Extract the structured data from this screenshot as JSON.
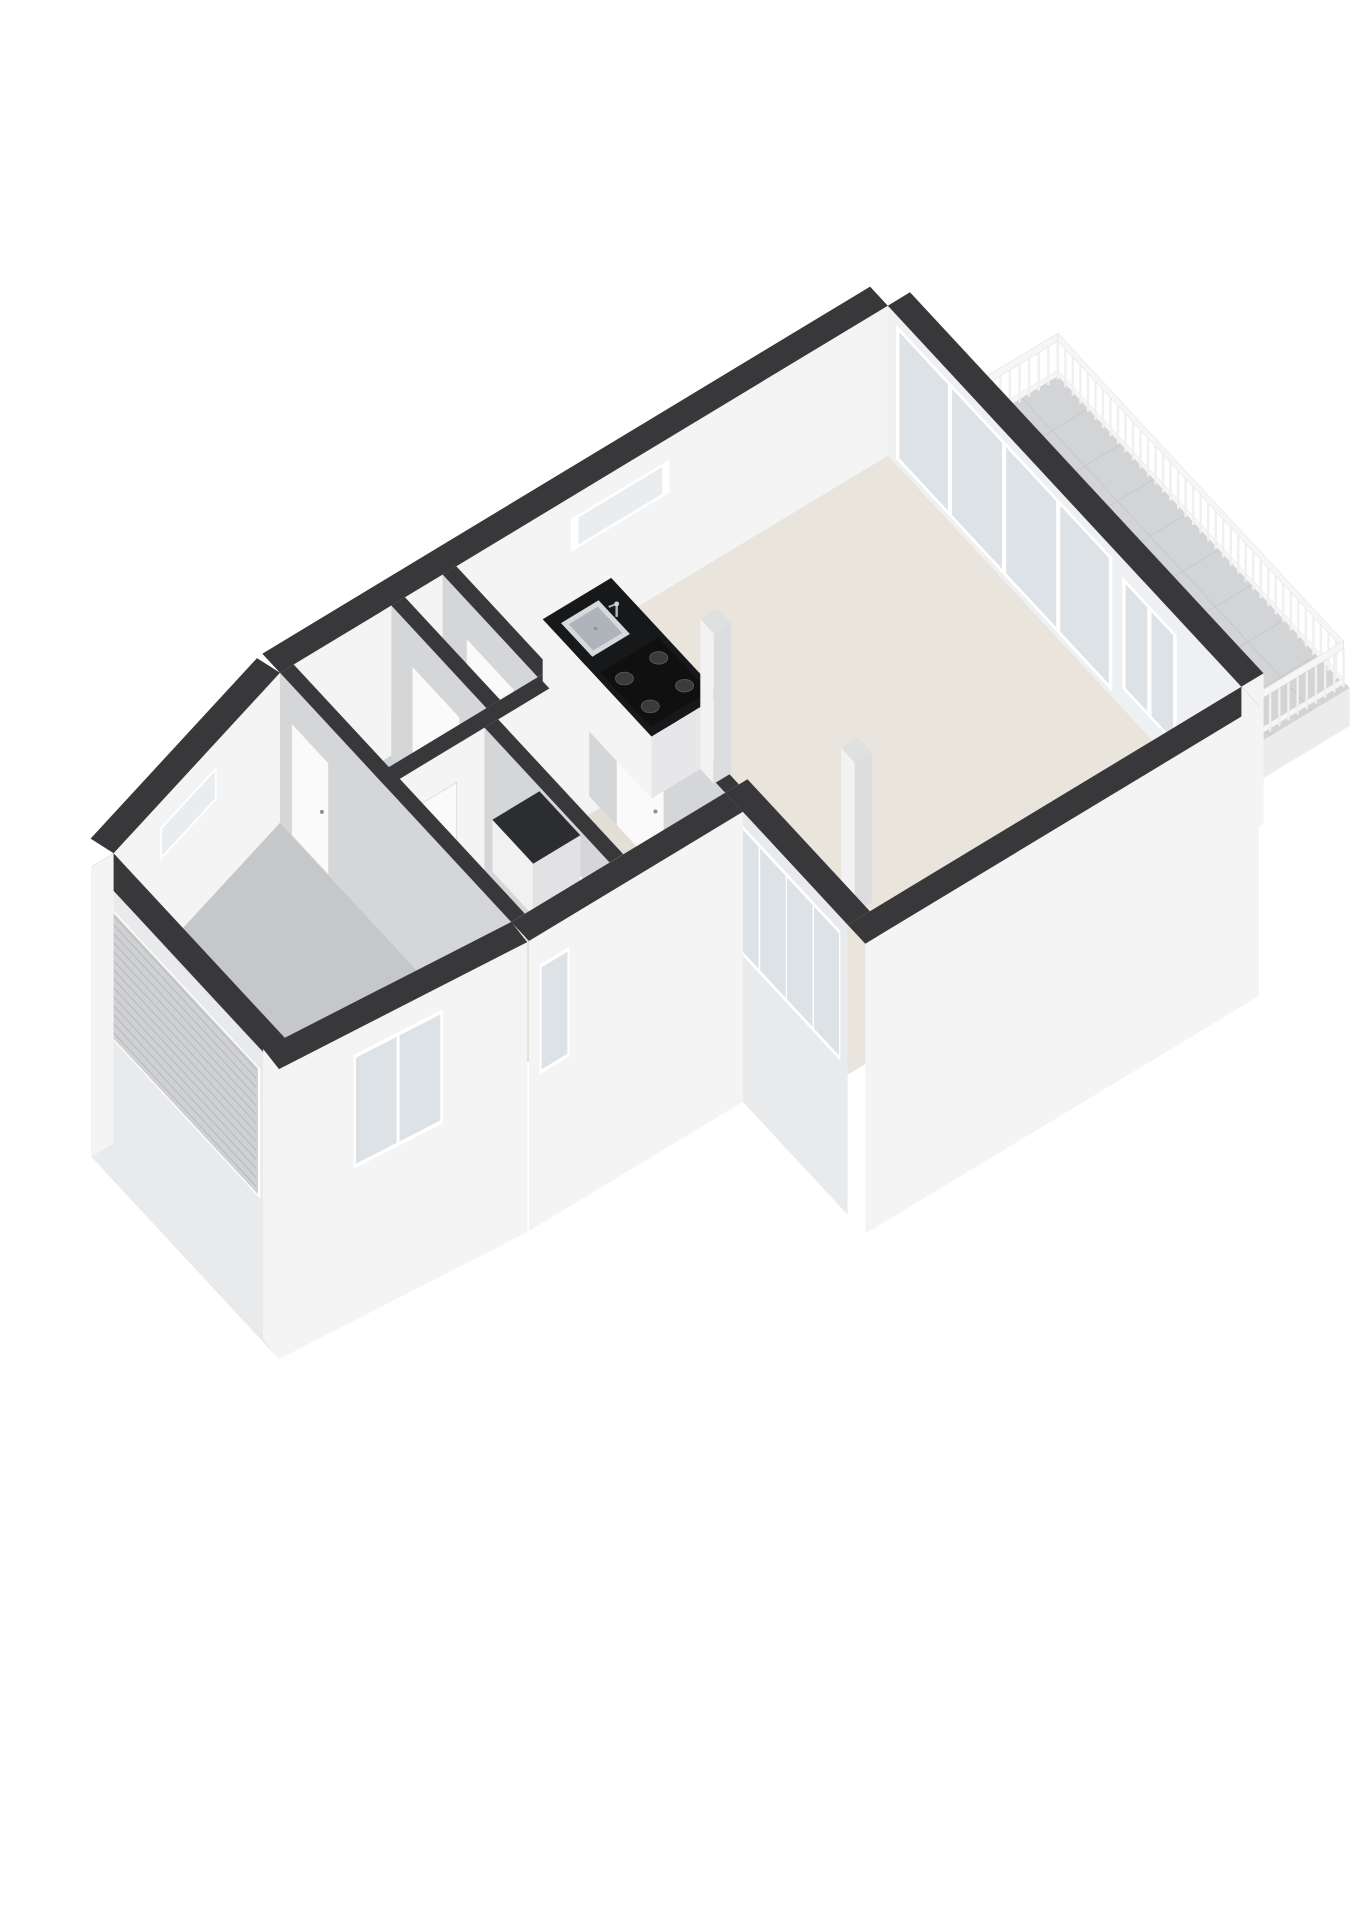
{
  "page": {
    "background": "#ffffff",
    "kind": "3d-floorplan-render"
  },
  "projection": {
    "origin": [
      66,
      952
    ],
    "dirU": [
      0.856,
      -0.517
    ],
    "dirV": [
      0.68,
      0.733
    ],
    "wallHeight": 150
  },
  "colors": {
    "wallTop": "#38383a",
    "faceLight": "#f4f4f5",
    "faceDark": "#d4d6d8",
    "faceExtShade": "#e9eaeb",
    "glassWallFace": "#eef0f2",
    "frame": "#ffffff",
    "glass": "#dde2e6",
    "slitInner": "#e9edf0",
    "garagePanel": "#d0d1d3",
    "garageLine": "#b9babc",
    "doorPanel": "#fafafa",
    "doorEdge": "#d8d8d8",
    "handle": "#8e8f92",
    "floorLiving": "#e9e5dc",
    "floorPale": "#e3dfd7",
    "floorBath": "#c9d2da",
    "floorKitchen": "#cdd6dd",
    "floorGarage": "#c6c7c8",
    "balconyFloor": "#d3d4d5",
    "balconyLine": "#c7c8c9",
    "fascia": "#ececed",
    "railPost": "#f0f0f1",
    "railTop": "#f6f6f7",
    "railEdge": "#d9dadb",
    "counterTop": "#17181a",
    "hob": "#101011",
    "burner": "#3a3b3d",
    "burnerEdge": "#565759",
    "sinkOuter": "#d6dadd",
    "sinkInner": "#aeb4b9",
    "steel": "#b4b8bc",
    "steelLight": "#ced2d5",
    "stepFill": "#f3f3f4",
    "stepAlt": "#eaeaec",
    "stepEdge": "#cfd0d2",
    "colTop": "#dfe0e2"
  },
  "elements": [
    {
      "type": "balcony",
      "name": "balcony-terrace",
      "z": -8,
      "floor": [
        [
          962,
          10
        ],
        [
          1150,
          10
        ],
        [
          1150,
          440
        ],
        [
          962,
          440
        ]
      ],
      "tileU": [
        1010,
        1058,
        1106
      ],
      "tileV": [
        58,
        106,
        154,
        202,
        250,
        298,
        346,
        394
      ],
      "fascia": [
        [
          [
            962,
            440
          ],
          [
            1150,
            440
          ]
        ],
        [
          [
            1150,
            440
          ],
          [
            1150,
            10
          ]
        ]
      ],
      "fasciaDepth": 38
    },
    {
      "type": "railing",
      "name": "balcony-railing-nw",
      "a": [
        978,
        16
      ],
      "b": [
        1146,
        16
      ],
      "zb": -8,
      "H": 46,
      "spacing": 11
    },
    {
      "type": "railing",
      "name": "balcony-railing-ne",
      "a": [
        1146,
        16
      ],
      "b": [
        1146,
        436
      ],
      "zb": -8,
      "H": 46,
      "spacing": 11
    },
    {
      "type": "railing",
      "name": "balcony-railing-se",
      "a": [
        1146,
        436
      ],
      "b": [
        964,
        436
      ],
      "zb": -8,
      "H": 46,
      "spacing": 11
    },
    {
      "type": "wall",
      "name": "facade-ne-glass",
      "a": [
        960,
        520
      ],
      "b": [
        960,
        0
      ],
      "n": [
        -1,
        0
      ],
      "t": 26,
      "apron": 0,
      "fill": "#eef0f2",
      "capA": true,
      "features": [
        {
          "style": "glass",
          "name": "sliding-glass-doors",
          "t0": 0.365,
          "t1": 0.977,
          "z0": 6,
          "z1": 140,
          "panes": 4
        },
        {
          "style": "glass",
          "name": "balcony-side-window",
          "t0": 0.183,
          "t1": 0.337,
          "z0": 20,
          "z1": 132,
          "panes": 2
        }
      ]
    },
    {
      "type": "wall",
      "name": "facade-nw",
      "a": [
        250,
        0
      ],
      "b": [
        960,
        0
      ],
      "n": [
        0,
        1
      ],
      "t": 26,
      "apron": 0,
      "features": [
        {
          "style": "slit",
          "name": "slit-window",
          "t0": 0.479,
          "t1": 0.641,
          "z0": 95,
          "z1": 128
        }
      ]
    },
    {
      "type": "wall",
      "name": "facade-nw-angled",
      "a": [
        0,
        70
      ],
      "b": [
        250,
        0
      ],
      "n": [
        0.27,
        0.96
      ],
      "t": 26,
      "apron": 0,
      "features": [
        {
          "style": "slit",
          "name": "slit-window",
          "t0": 0.28,
          "t1": 0.62,
          "z0": 92,
          "z1": 125
        }
      ]
    },
    {
      "type": "floor",
      "name": "floor-garage",
      "fillKey": "floorGarage",
      "pts": [
        [
          0,
          70
        ],
        [
          250,
          0
        ],
        [
          250,
          340
        ],
        [
          0,
          320
        ]
      ]
    },
    {
      "type": "floor",
      "name": "floor-bathroom",
      "fillKey": "floorBath",
      "pts": [
        [
          266,
          0
        ],
        [
          380,
          0
        ],
        [
          380,
          140
        ],
        [
          266,
          140
        ]
      ]
    },
    {
      "type": "floor",
      "name": "floor-hallway",
      "fillKey": "floorPale",
      "pts": [
        [
          380,
          0
        ],
        [
          440,
          0
        ],
        [
          440,
          140
        ],
        [
          380,
          140
        ]
      ]
    },
    {
      "type": "floor",
      "name": "floor-kitchen",
      "fillKey": "floorKitchen",
      "pts": [
        [
          440,
          0
        ],
        [
          545,
          0
        ],
        [
          545,
          140
        ],
        [
          440,
          140
        ]
      ]
    },
    {
      "type": "floor",
      "name": "floor-storage",
      "fillKey": "floorPale",
      "pts": [
        [
          266,
          156
        ],
        [
          365,
          156
        ],
        [
          365,
          340
        ],
        [
          266,
          340
        ]
      ]
    },
    {
      "type": "floor",
      "name": "floor-study",
      "fillKey": "floorPale",
      "pts": [
        [
          365,
          156
        ],
        [
          500,
          156
        ],
        [
          500,
          340
        ],
        [
          365,
          340
        ]
      ]
    },
    {
      "type": "floor",
      "name": "floor-living-room",
      "fillKey": "floorLiving",
      "pts": [
        [
          545,
          0
        ],
        [
          960,
          0
        ],
        [
          960,
          520
        ],
        [
          500,
          520
        ],
        [
          500,
          140
        ],
        [
          545,
          140
        ]
      ]
    },
    {
      "type": "wall",
      "name": "wall-kitchen-hall",
      "a": [
        440,
        0
      ],
      "b": [
        440,
        140
      ],
      "n": [
        -1,
        0
      ],
      "t": 16,
      "capB": true,
      "features": [
        {
          "style": "door",
          "name": "interior-door",
          "t0": 0.25,
          "t1": 0.75
        }
      ]
    },
    {
      "type": "wall",
      "name": "wall-bathroom-hall",
      "a": [
        380,
        0
      ],
      "b": [
        380,
        140
      ],
      "n": [
        -1,
        0
      ],
      "t": 16,
      "capB": true,
      "features": [
        {
          "style": "door",
          "name": "interior-door",
          "t0": 0.22,
          "t1": 0.72
        }
      ]
    },
    {
      "type": "wall",
      "name": "wall-middle",
      "a": [
        250,
        156
      ],
      "b": [
        500,
        156
      ],
      "n": [
        0,
        1
      ],
      "t": 16,
      "features": [
        {
          "style": "door",
          "name": "interior-door",
          "t0": 0.1,
          "t1": 0.33
        }
      ]
    },
    {
      "type": "wall",
      "name": "wall-study-living",
      "a": [
        500,
        140
      ],
      "b": [
        500,
        340
      ],
      "n": [
        -1,
        0
      ],
      "t": 16,
      "features": [
        {
          "style": "door",
          "name": "interior-door",
          "t0": 0.2,
          "t1": 0.55
        }
      ]
    },
    {
      "type": "wall",
      "name": "wall-storage-study",
      "a": [
        365,
        156
      ],
      "b": [
        365,
        340
      ],
      "n": [
        -1,
        0
      ],
      "t": 16,
      "capB": true,
      "features": [
        {
          "style": "pass",
          "name": "pass-through-window",
          "t0": 0.5,
          "t1": 0.78,
          "z0": 55,
          "z1": 105
        }
      ]
    },
    {
      "type": "wall",
      "name": "wall-garage",
      "a": [
        250,
        0
      ],
      "b": [
        250,
        340
      ],
      "n": [
        -1,
        0
      ],
      "t": 16,
      "capB": true,
      "features": [
        {
          "style": "door",
          "name": "interior-door",
          "t0": 0.05,
          "t1": 0.21
        }
      ]
    },
    {
      "type": "box",
      "name": "kitchen-counter",
      "u0": 545,
      "u1": 625,
      "v0": 15,
      "v1": 175,
      "h": 62,
      "top": "#17181a",
      "fU": "#f4f4f5",
      "fV": "#e7e7e9",
      "kitchen": true,
      "sink": {
        "u0": 556,
        "u1": 600,
        "v0": 28,
        "v1": 74
      },
      "hob": {
        "u0": 551,
        "u1": 619,
        "v0": 92,
        "v1": 166
      },
      "burners": [
        [
          565,
          110
        ],
        [
          565,
          148
        ],
        [
          605,
          110
        ],
        [
          605,
          148
        ]
      ],
      "faucet": [
        602,
        52
      ]
    },
    {
      "type": "box",
      "name": "storage-cabinet",
      "u0": 375,
      "u1": 430,
      "v0": 155,
      "v1": 215,
      "h": 52,
      "top": "#2c2d2f",
      "fU": "#f1f1f2",
      "fV": "#e2e2e4"
    },
    {
      "type": "box",
      "name": "structural-column-a",
      "u0": 602,
      "u1": 622,
      "v0": 175,
      "v1": 195,
      "h": 150,
      "top": "#dfe0e2",
      "fU": "#f2f2f3",
      "fV": "#dcdcde"
    },
    {
      "type": "box",
      "name": "structural-column-b",
      "u0": 618,
      "u1": 638,
      "v0": 362,
      "v1": 382,
      "h": 150,
      "top": "#dfe0e2",
      "fU": "#f2f2f3",
      "fV": "#dcdcde"
    },
    {
      "type": "stairs",
      "name": "winder-staircase",
      "pivot": [
        575,
        425
      ],
      "r": 95,
      "a0": 180,
      "a1": 270,
      "steps": 5
    },
    {
      "type": "wall",
      "name": "facade-se-living",
      "a": [
        500,
        546
      ],
      "b": [
        960,
        546
      ],
      "n": [
        0,
        1
      ],
      "t": 26,
      "apron": 140,
      "capB": true
    },
    {
      "type": "wall",
      "name": "facade-se-jog",
      "a": [
        500,
        340
      ],
      "b": [
        500,
        520
      ],
      "n": [
        -1,
        0
      ],
      "t": 26,
      "apron": 140,
      "fill": "#e9eaeb",
      "features": [
        {
          "style": "glass",
          "name": "window-band",
          "t0": 0.06,
          "t1": 0.94,
          "z0": 6,
          "z1": 136,
          "panes": 4
        }
      ]
    },
    {
      "type": "wall",
      "name": "facade-se-mid",
      "a": [
        250,
        366
      ],
      "b": [
        500,
        366
      ],
      "n": [
        0,
        1
      ],
      "t": 26,
      "apron": 140,
      "features": [
        {
          "style": "glass",
          "name": "window",
          "t0": 0.05,
          "t1": 0.19,
          "z0": 10,
          "z1": 120,
          "panes": 1
        }
      ]
    },
    {
      "type": "wall",
      "name": "facade-sw-garage",
      "a": [
        -26,
        346
      ],
      "b": [
        -26,
        70
      ],
      "n": [
        -1,
        0
      ],
      "t": 26,
      "apron": 140,
      "fill": "#e9eaeb",
      "capA": true,
      "capB": true,
      "features": [
        {
          "style": "garage",
          "name": "garage-roller-door",
          "t0": 0.1,
          "t1": 0.92,
          "z0": 0,
          "z1": 130
        }
      ]
    },
    {
      "type": "wall",
      "name": "facade-se-angled",
      "a": [
        -26,
        346
      ],
      "b": [
        248,
        366
      ],
      "n": [
        -0.08,
        1
      ],
      "t": 26,
      "apron": 140,
      "capA": true,
      "features": [
        {
          "style": "glass",
          "name": "window",
          "t0": 0.3,
          "t1": 0.66,
          "z0": 12,
          "z1": 126,
          "panes": 2
        }
      ]
    }
  ]
}
